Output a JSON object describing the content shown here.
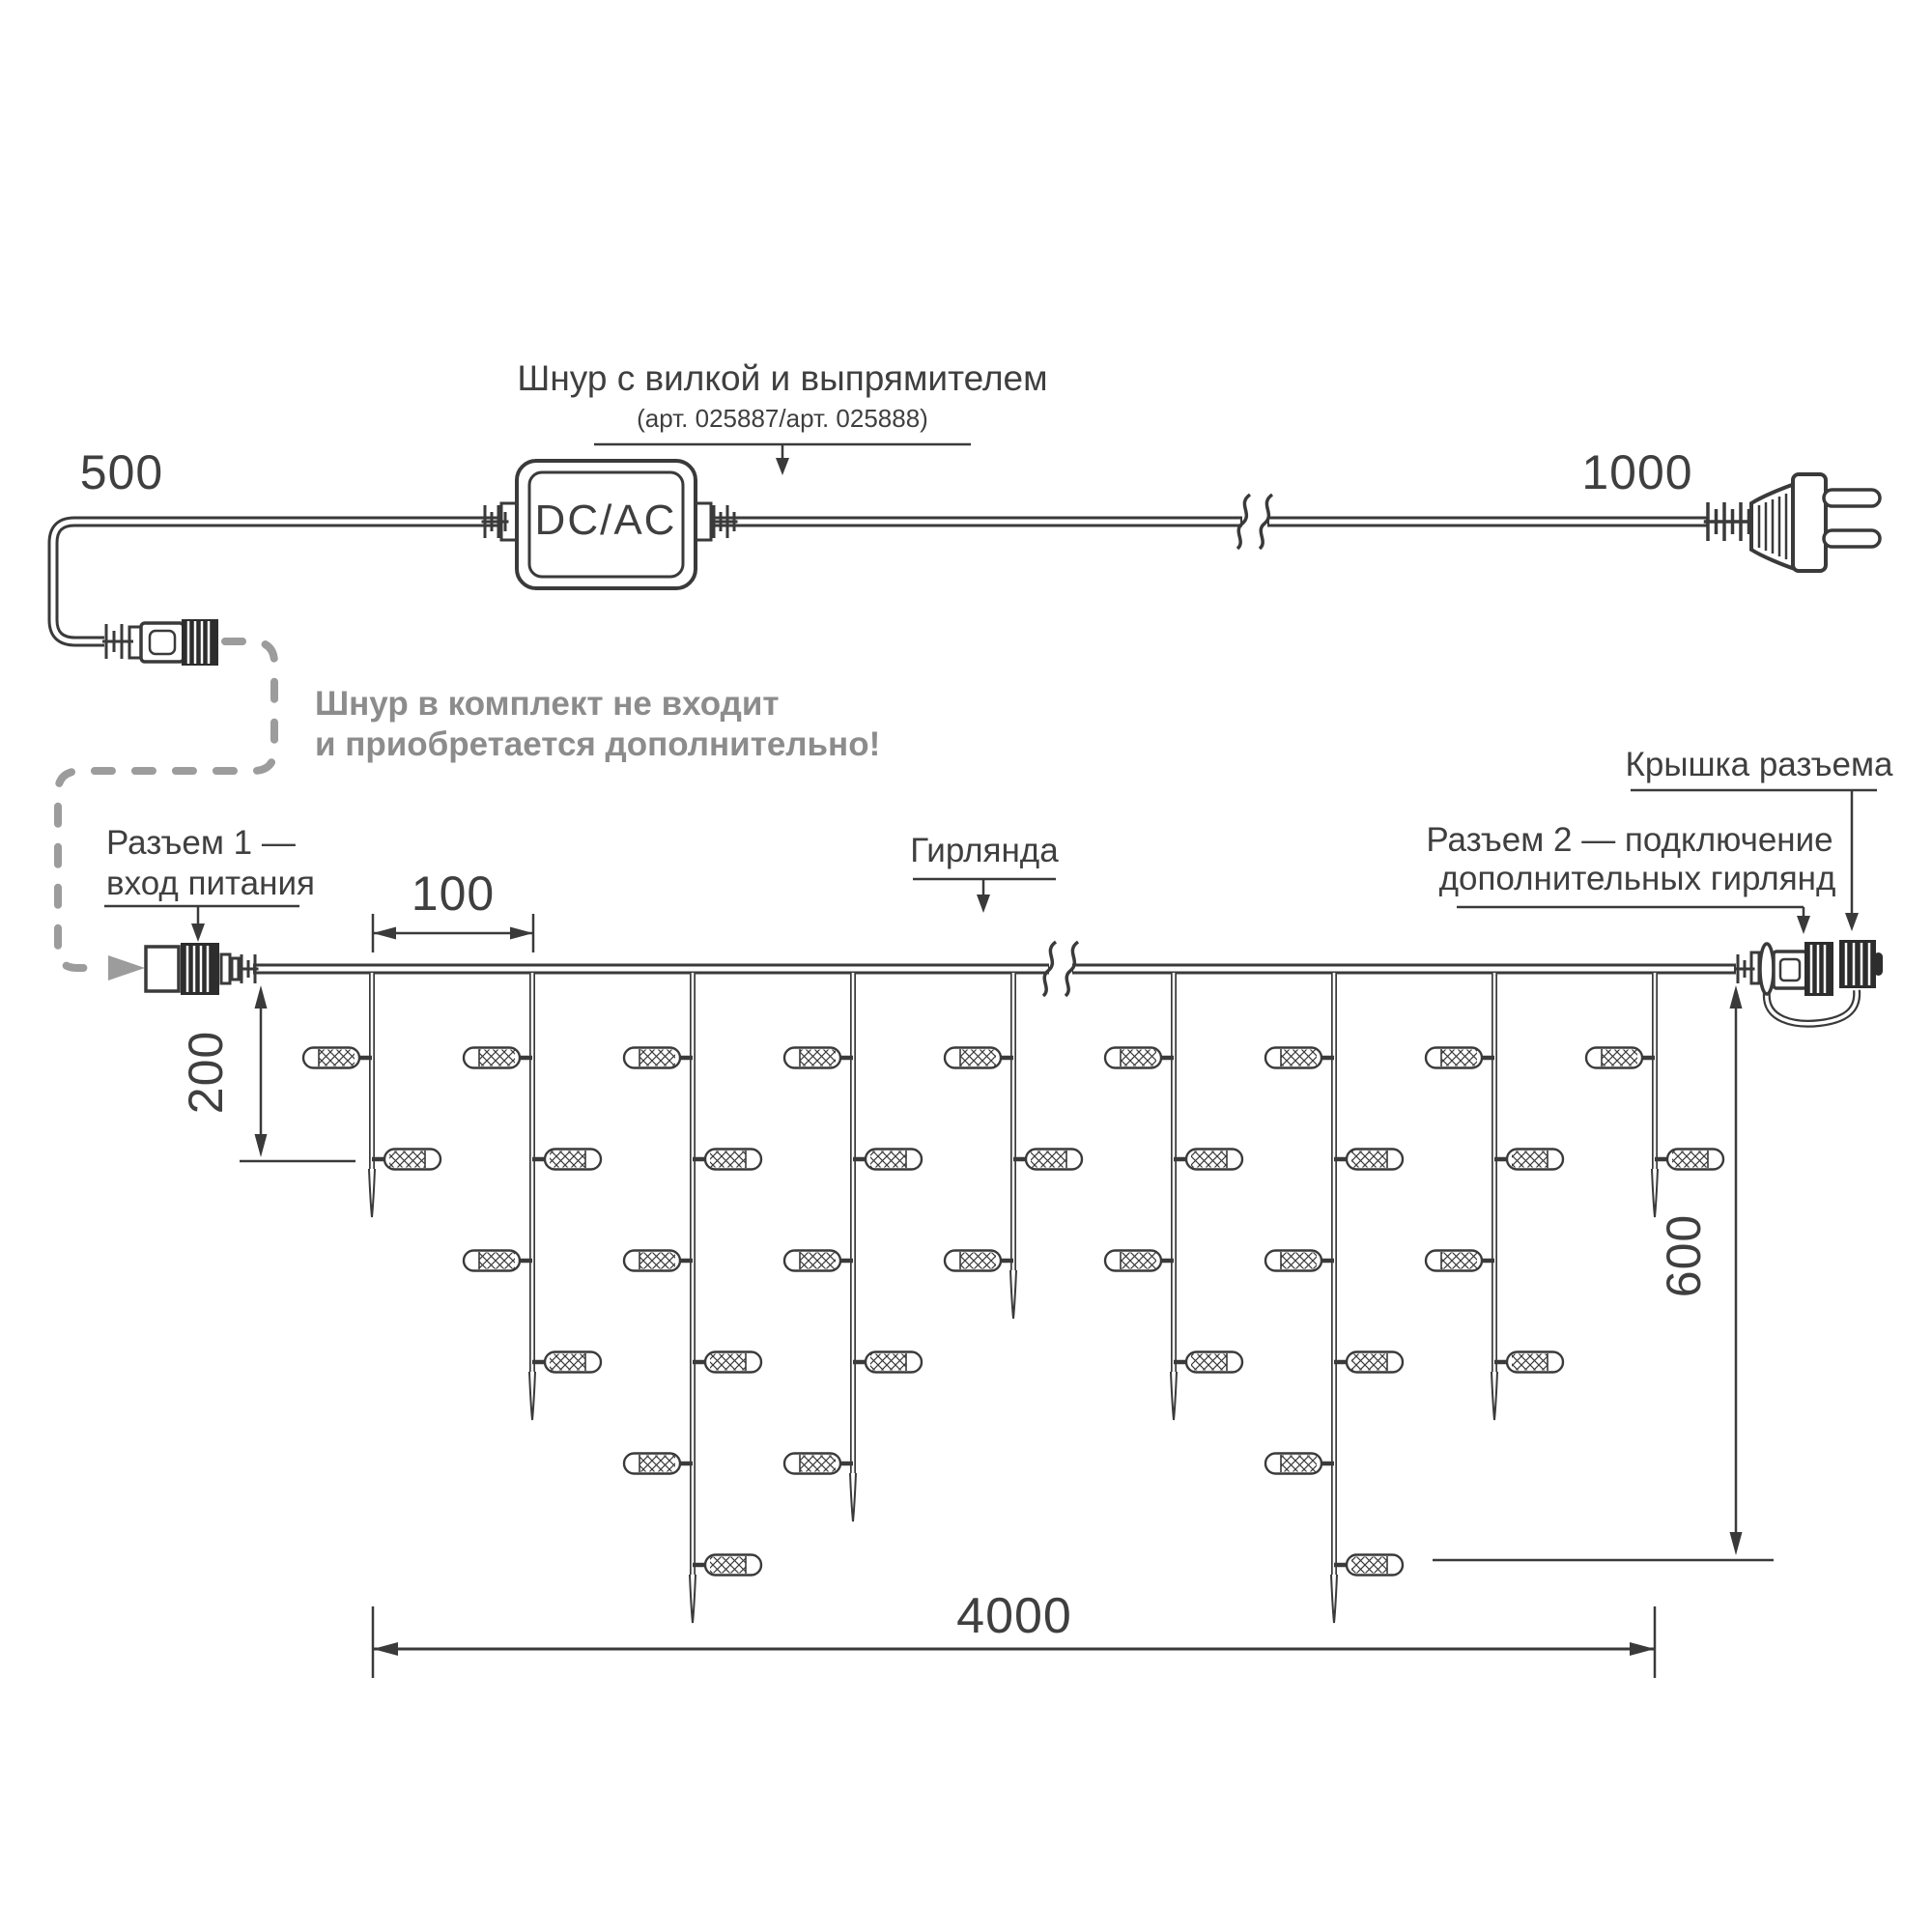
{
  "colors": {
    "line": "#3a3a3a",
    "text": "#3f3f3f",
    "note_gray": "#8c8c8c",
    "dash_gray": "#9c9c9c"
  },
  "top": {
    "dim_left": "500",
    "dim_right": "1000",
    "title": "Шнур с вилкой и выпрямителем",
    "subtitle": "(арт. 025887/арт. 025888)",
    "adapter_label": "DC/AC",
    "note_line1": "Шнур в комплект не входит",
    "note_line2": "и приобретается дополнительно!"
  },
  "garland": {
    "connector1_line1": "Разъем 1 —",
    "connector1_line2": "вход питания",
    "label": "Гирлянда",
    "connector2_line1": "Разъем 2 — подключение",
    "connector2_line2": "дополнительных гирлянд",
    "cap_label": "Крышка разъема",
    "dim_spacing": "100",
    "dim_drop_length": "200",
    "dim_height": "600",
    "dim_total_length": "4000"
  }
}
